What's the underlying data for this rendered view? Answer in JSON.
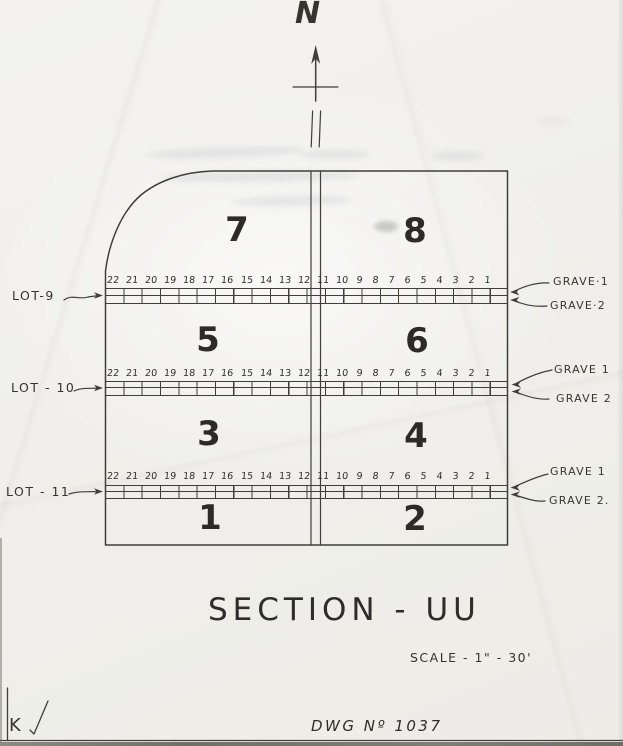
{
  "drawing": {
    "north_label": "N",
    "title": "SECTION - UU",
    "scale": "SCALE - 1\" - 30'",
    "dwg_number": "DWG   Nº 1037",
    "reviewer_initial": "K"
  },
  "sections": [
    {
      "number": "7"
    },
    {
      "number": "8"
    },
    {
      "number": "5"
    },
    {
      "number": "6"
    },
    {
      "number": "3"
    },
    {
      "number": "4"
    },
    {
      "number": "1"
    },
    {
      "number": "2"
    }
  ],
  "grave_numbers": [
    "22",
    "21",
    "20",
    "19",
    "18",
    "17",
    "16",
    "15",
    "14",
    "13",
    "12",
    "11",
    "10",
    "9",
    "8",
    "7",
    "6",
    "5",
    "4",
    "3",
    "2",
    "1"
  ],
  "lots": [
    {
      "label": "LOT-9",
      "grave1": "GRAVE·1",
      "grave2": "GRAVE·2"
    },
    {
      "label": "LOT - 10",
      "grave1": "GRAVE 1",
      "grave2": "GRAVE 2"
    },
    {
      "label": "LOT - 11",
      "grave1": "GRAVE 1",
      "grave2": "GRAVE 2."
    }
  ],
  "colors": {
    "ink": "#3f3e3a",
    "paper": "#f1f0ec"
  }
}
